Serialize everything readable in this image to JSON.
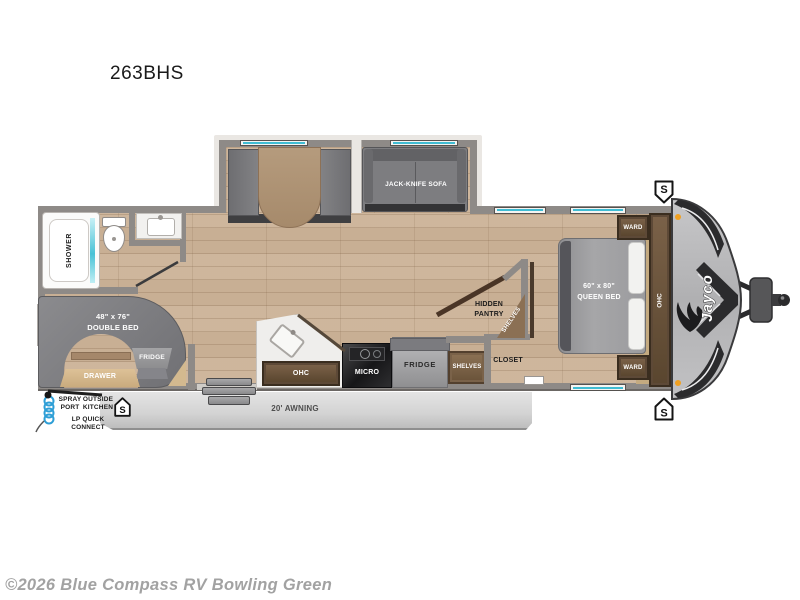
{
  "title": "263BHS",
  "watermark": "©2026 Blue Compass RV Bowling Green",
  "brand": "Jayco",
  "colors": {
    "wall": "#8e8a87",
    "floor_wood": "#c8af94",
    "window_accent": "#3fbcd3",
    "front_cap": "#b4b4b6",
    "chevron": "#2b2b2d",
    "clearance_light": "#f0a020",
    "cabinet_wood": "#5d4937",
    "awning": "#d6d6d6",
    "watermark_text": "#a2a2a2",
    "spray_hose": "#2d9ed6"
  },
  "labels": {
    "speaker": "S",
    "shower": "SHOWER",
    "double_bed_size": "48\" x 76\"",
    "double_bed_name": "DOUBLE BED",
    "bed_fridge": "FRIDGE",
    "drawer": "DRAWER",
    "kitchen_ohc": "OHC",
    "micro": "MICRO",
    "fridge": "FRIDGE",
    "kitchen_shelves": "SHELVES",
    "closet": "CLOSET",
    "hidden_pantry_line1": "HIDDEN",
    "hidden_pantry_line2": "PANTRY",
    "pantry_shelves": "SHELVES",
    "queen_bed_size": "60\" x 80\"",
    "queen_bed_name": "QUEEN BED",
    "ward_top": "WARD",
    "ward_bottom": "WARD",
    "bedroom_ohc": "OHC",
    "sofa": "JACK-KNIFE SOFA",
    "awning": "20' AWNING",
    "spray_line1": "SPRAY",
    "spray_line2": "PORT",
    "outside_line1": "OUTSIDE",
    "outside_line2": "KITCHEN",
    "lp_line1": "LP QUICK",
    "lp_line2": "CONNECT"
  }
}
